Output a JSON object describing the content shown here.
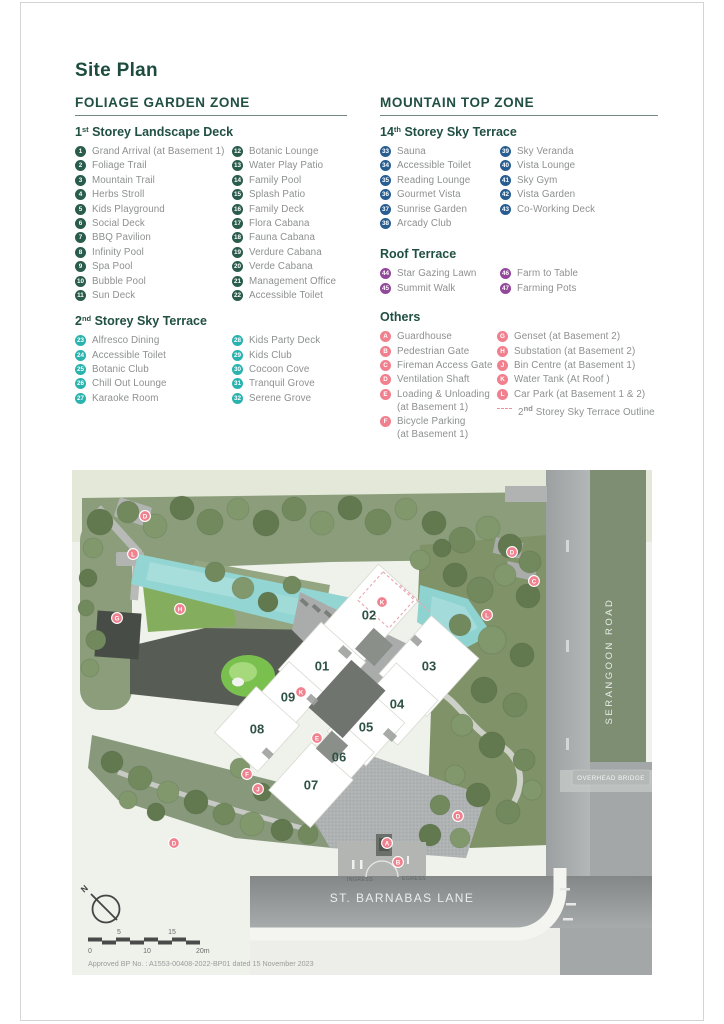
{
  "title": "Site Plan",
  "zones": {
    "left": {
      "title": "FOLIAGE GARDEN ZONE",
      "sections": [
        {
          "heading": {
            "pre": "1",
            "sup": "st",
            "rest": " Storey Landscape Deck"
          },
          "badge_color": "#2a5c4e",
          "columns": [
            [
              {
                "num": "1",
                "label": "Grand Arrival (at Basement 1)"
              },
              {
                "num": "2",
                "label": "Foliage Trail"
              },
              {
                "num": "3",
                "label": "Mountain Trail"
              },
              {
                "num": "4",
                "label": "Herbs Stroll"
              },
              {
                "num": "5",
                "label": "Kids Playground"
              },
              {
                "num": "6",
                "label": "Social Deck"
              },
              {
                "num": "7",
                "label": "BBQ Pavilion"
              },
              {
                "num": "8",
                "label": "Infinity Pool"
              },
              {
                "num": "9",
                "label": "Spa Pool"
              },
              {
                "num": "10",
                "label": "Bubble Pool"
              },
              {
                "num": "11",
                "label": "Sun Deck"
              }
            ],
            [
              {
                "num": "12",
                "label": "Botanic Lounge"
              },
              {
                "num": "13",
                "label": "Water Play Patio"
              },
              {
                "num": "14",
                "label": "Family Pool"
              },
              {
                "num": "15",
                "label": "Splash Patio"
              },
              {
                "num": "16",
                "label": "Family Deck"
              },
              {
                "num": "17",
                "label": "Flora Cabana"
              },
              {
                "num": "18",
                "label": "Fauna Cabana"
              },
              {
                "num": "19",
                "label": "Verdure Cabana"
              },
              {
                "num": "20",
                "label": "Verde Cabana"
              },
              {
                "num": "21",
                "label": "Management Office"
              },
              {
                "num": "22",
                "label": "Accessible Toilet"
              }
            ]
          ]
        },
        {
          "heading": {
            "pre": "2",
            "sup": "nd",
            "rest": " Storey Sky Terrace"
          },
          "badge_color": "#2ab3ae",
          "columns": [
            [
              {
                "num": "23",
                "label": "Alfresco Dining"
              },
              {
                "num": "24",
                "label": "Accessible Toilet"
              },
              {
                "num": "25",
                "label": "Botanic Club"
              },
              {
                "num": "26",
                "label": "Chill Out Lounge"
              },
              {
                "num": "27",
                "label": "Karaoke Room"
              }
            ],
            [
              {
                "num": "28",
                "label": "Kids Party Deck"
              },
              {
                "num": "29",
                "label": "Kids Club"
              },
              {
                "num": "30",
                "label": "Cocoon Cove"
              },
              {
                "num": "31",
                "label": "Tranquil Grove"
              },
              {
                "num": "32",
                "label": "Serene Grove"
              }
            ]
          ]
        }
      ]
    },
    "right": {
      "title": "MOUNTAIN TOP ZONE",
      "sections": [
        {
          "heading": {
            "pre": "14",
            "sup": "th",
            "rest": " Storey Sky Terrace"
          },
          "badge_color": "#275d91",
          "columns": [
            [
              {
                "num": "33",
                "label": "Sauna"
              },
              {
                "num": "34",
                "label": "Accessible Toilet"
              },
              {
                "num": "35",
                "label": "Reading Lounge"
              },
              {
                "num": "36",
                "label": "Gourmet Vista"
              },
              {
                "num": "37",
                "label": "Sunrise Garden"
              },
              {
                "num": "38",
                "label": "Arcady Club"
              }
            ],
            [
              {
                "num": "39",
                "label": "Sky Veranda"
              },
              {
                "num": "40",
                "label": "Vista Lounge"
              },
              {
                "num": "41",
                "label": "Sky Gym"
              },
              {
                "num": "42",
                "label": "Vista Garden"
              },
              {
                "num": "43",
                "label": "Co-Working Deck"
              }
            ]
          ]
        },
        {
          "heading": {
            "pre": "Roof Terrace",
            "sup": "",
            "rest": ""
          },
          "badge_color": "#91489b",
          "columns": [
            [
              {
                "num": "44",
                "label": "Star Gazing Lawn"
              },
              {
                "num": "45",
                "label": "Summit Walk"
              }
            ],
            [
              {
                "num": "46",
                "label": "Farm to Table"
              },
              {
                "num": "47",
                "label": "Farming Pots"
              }
            ]
          ]
        }
      ]
    }
  },
  "others": {
    "title": "Others",
    "badge_color": "#f0808e",
    "columns": [
      [
        {
          "num": "A",
          "label": "Guardhouse"
        },
        {
          "num": "B",
          "label": "Pedestrian Gate"
        },
        {
          "num": "C",
          "label": "Fireman Access Gate"
        },
        {
          "num": "D",
          "label": "Ventilation Shaft"
        },
        {
          "num": "E",
          "label": "Loading & Unloading",
          "sub": "(at Basement 1)"
        },
        {
          "num": "F",
          "label": "Bicycle Parking",
          "sub": "(at Basement 1)"
        }
      ],
      [
        {
          "num": "G",
          "label": "Genset (at Basement 2)"
        },
        {
          "num": "H",
          "label": "Substation (at Basement 2)"
        },
        {
          "num": "J",
          "label": "Bin Centre (at Basement 1)"
        },
        {
          "num": "K",
          "label": "Water Tank (At Roof )"
        },
        {
          "num": "L",
          "label": "Car Park (at Basement 1 & 2)"
        },
        {
          "dash": true,
          "pre": "2",
          "sup": "nd",
          "rest": " Storey Sky Terrace Outline"
        }
      ]
    ]
  },
  "map": {
    "buildings": [
      {
        "num": "02",
        "x": 369,
        "y": 615,
        "w": 54,
        "h": 88
      },
      {
        "num": "01",
        "x": 322,
        "y": 666,
        "w": 60,
        "h": 64
      },
      {
        "num": "03",
        "x": 429,
        "y": 666,
        "w": 64,
        "h": 78
      },
      {
        "num": "09",
        "x": 288,
        "y": 697,
        "w": 46,
        "h": 54
      },
      {
        "num": "04",
        "x": 397,
        "y": 704,
        "w": 56,
        "h": 60
      },
      {
        "num": "08",
        "x": 257,
        "y": 729,
        "w": 58,
        "h": 62
      },
      {
        "num": "05",
        "x": 366,
        "y": 727,
        "w": 52,
        "h": 58
      },
      {
        "num": "06",
        "x": 339,
        "y": 757,
        "w": 46,
        "h": 54
      },
      {
        "num": "07",
        "x": 311,
        "y": 785,
        "w": 56,
        "h": 64
      }
    ],
    "markers": [
      {
        "letter": "D",
        "x": 145,
        "y": 516
      },
      {
        "letter": "L",
        "x": 133,
        "y": 554
      },
      {
        "letter": "H",
        "x": 180,
        "y": 609
      },
      {
        "letter": "G",
        "x": 117,
        "y": 618
      },
      {
        "letter": "D",
        "x": 512,
        "y": 552
      },
      {
        "letter": "C",
        "x": 534,
        "y": 581
      },
      {
        "letter": "L",
        "x": 487,
        "y": 615
      },
      {
        "letter": "K",
        "x": 382,
        "y": 602
      },
      {
        "letter": "K",
        "x": 301,
        "y": 692
      },
      {
        "letter": "E",
        "x": 317,
        "y": 738
      },
      {
        "letter": "F",
        "x": 247,
        "y": 774
      },
      {
        "letter": "J",
        "x": 258,
        "y": 789
      },
      {
        "letter": "D",
        "x": 174,
        "y": 843
      },
      {
        "letter": "D",
        "x": 458,
        "y": 816
      },
      {
        "letter": "A",
        "x": 387,
        "y": 843
      },
      {
        "letter": "B",
        "x": 398,
        "y": 862
      }
    ],
    "labels": {
      "serangoon_road": "SERANGOON ROAD",
      "st_barnabas_lane": "ST. BARNABAS LANE",
      "overhead_bridge": "OVERHEAD BRIDGE",
      "ingress": "INGRESS",
      "egress": "EGRESS",
      "north": "N"
    },
    "scale": {
      "t5": "5",
      "t15": "15",
      "b0": "0",
      "b10": "10",
      "b20": "20m"
    },
    "approval": "Approved BP No. : A1553-00408-2022-BP01 dated 15 November 2023"
  }
}
